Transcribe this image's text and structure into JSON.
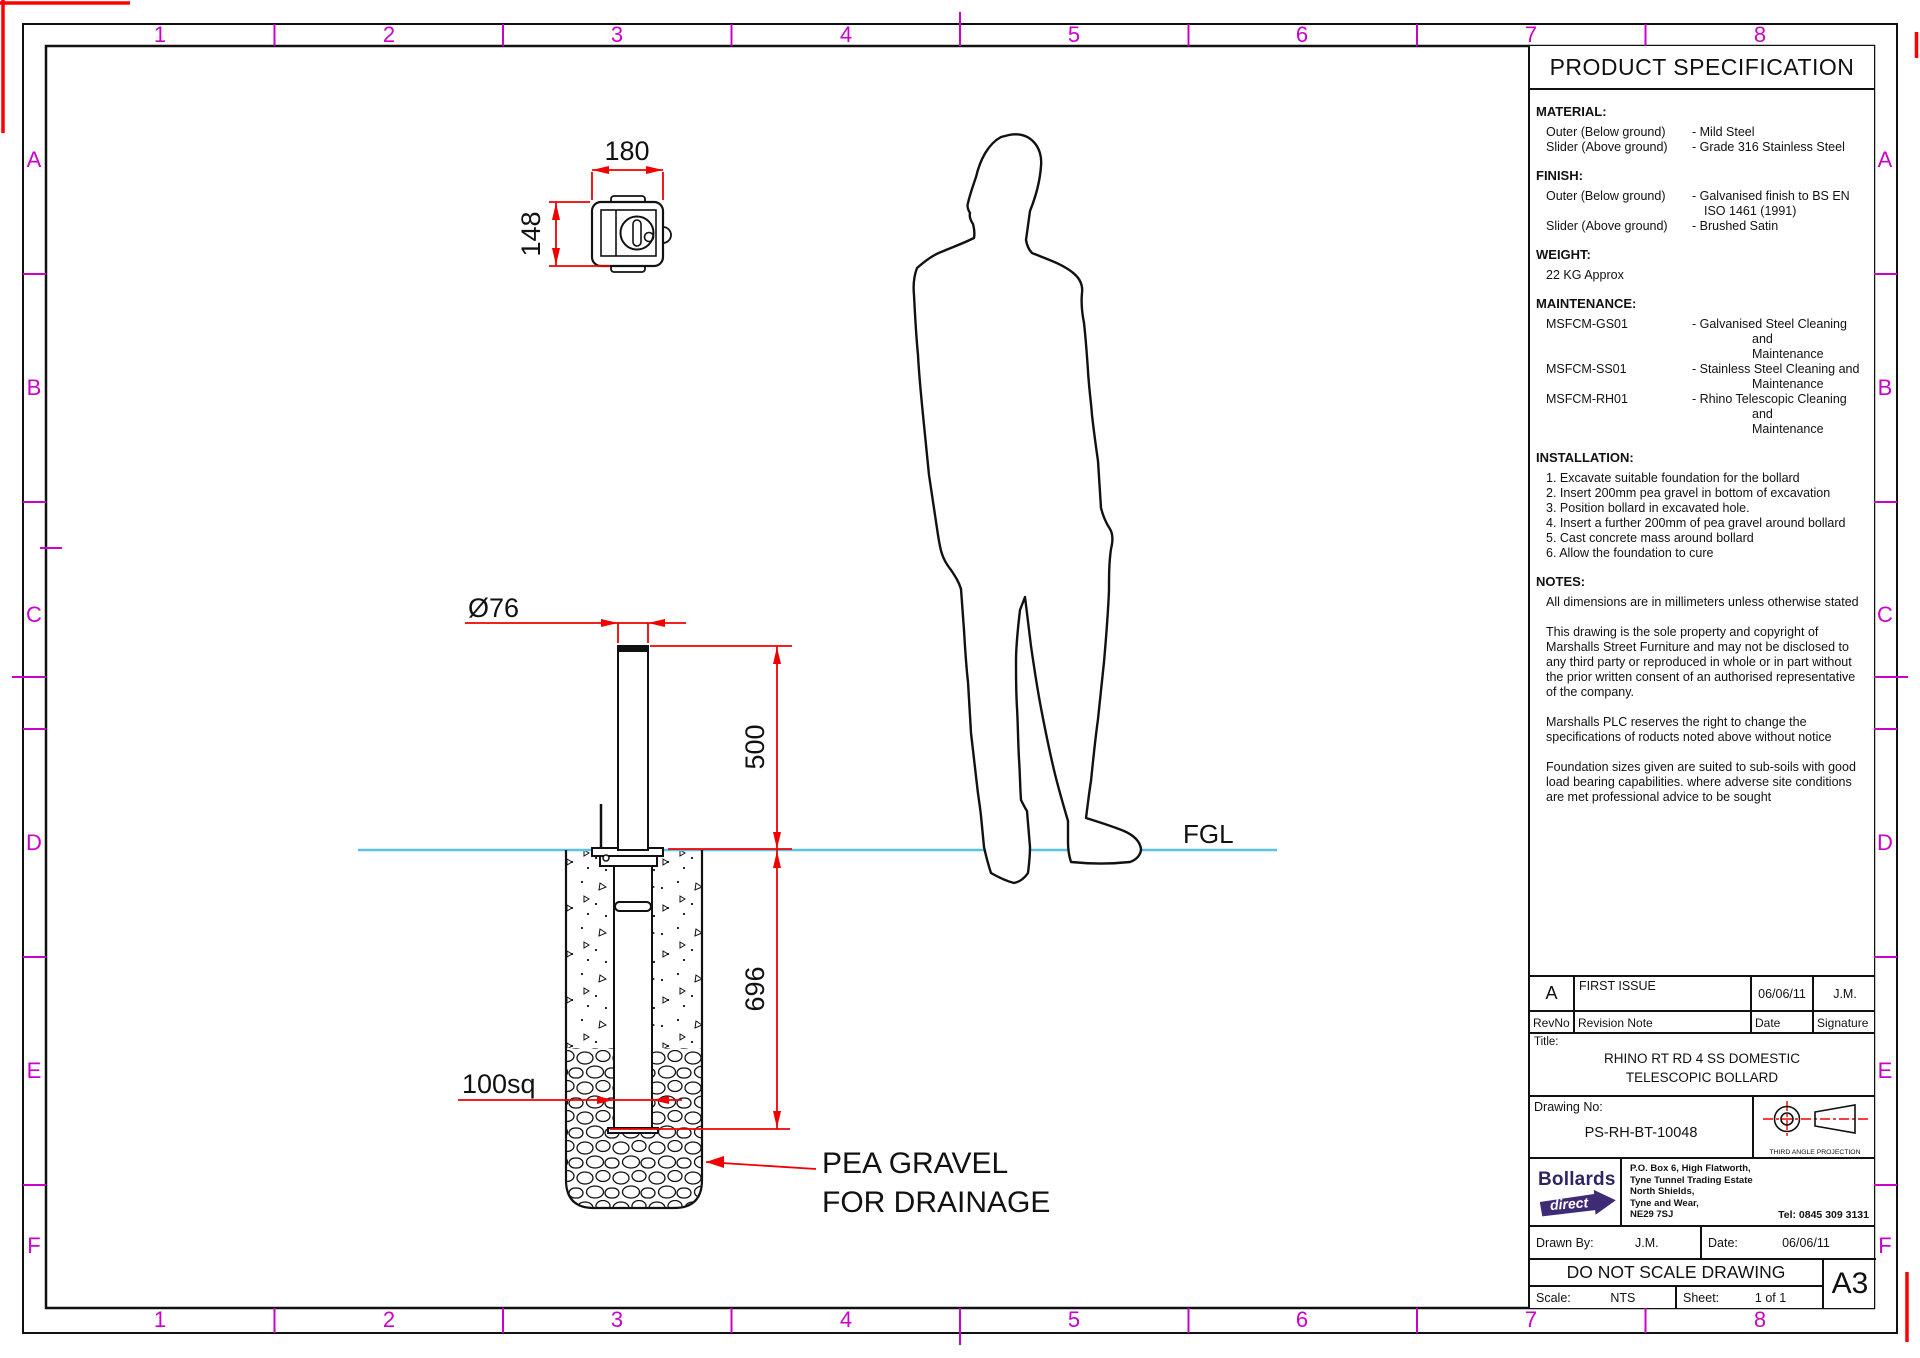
{
  "grid": {
    "top": [
      "1",
      "2",
      "3",
      "4",
      "5",
      "6",
      "7",
      "8"
    ],
    "bottom": [
      "1",
      "2",
      "3",
      "4",
      "5",
      "6",
      "7",
      "8"
    ],
    "left": [
      "A",
      "B",
      "C",
      "D",
      "E",
      "F"
    ],
    "right": [
      "A",
      "B",
      "C",
      "D",
      "E",
      "F"
    ],
    "label_color": "#cc00cc"
  },
  "drawing": {
    "dims": {
      "plan_width": "180",
      "plan_height": "148",
      "post_dia": "Ø76",
      "above_ground": "500",
      "below_ground": "696",
      "tube_square": "100sq"
    },
    "labels": {
      "fgl": "FGL",
      "pea_line1": "PEA GRAVEL",
      "pea_line2": "FOR DRAINAGE"
    },
    "colors": {
      "dimension": "#f00000",
      "corner_mark": "#ff0000",
      "ground_line": "#5bc2e7",
      "grid_tick": "#cc00cc",
      "outline": "#111111"
    }
  },
  "spec_panel": {
    "header": "PRODUCT SPECIFICATION",
    "material": {
      "heading": "MATERIAL:",
      "rows": [
        {
          "name": "Outer (Below ground)",
          "value": "- Mild Steel"
        },
        {
          "name": "Slider (Above ground)",
          "value": "- Grade 316 Stainless Steel"
        }
      ]
    },
    "finish": {
      "heading": "FINISH:",
      "rows": [
        {
          "name": "Outer (Below ground)",
          "value": "- Galvanised finish to BS EN\nISO 1461 (1991)"
        },
        {
          "name": "Slider (Above ground)",
          "value": "- Brushed Satin"
        }
      ]
    },
    "weight": {
      "heading": "WEIGHT:",
      "value": "22 KG Approx"
    },
    "maintenance": {
      "heading": "MAINTENANCE:",
      "rows": [
        {
          "name": "MSFCM-GS01",
          "value": "- Galvanised Steel Cleaning and\nMaintenance"
        },
        {
          "name": "MSFCM-SS01",
          "value": "- Stainless Steel Cleaning and\nMaintenance"
        },
        {
          "name": "MSFCM-RH01",
          "value": "- Rhino Telescopic Cleaning and\nMaintenance"
        }
      ]
    },
    "installation": {
      "heading": "INSTALLATION:",
      "steps": [
        "1. Excavate suitable foundation for the bollard",
        "2. Insert 200mm pea gravel in bottom of excavation",
        "3. Position bollard in excavated hole.",
        "4. Insert a further 200mm of pea gravel around bollard",
        "5. Cast concrete mass around bollard",
        "6. Allow the foundation to cure"
      ]
    },
    "notes": {
      "heading": "NOTES:",
      "paragraphs": [
        "All dimensions are in millimeters unless otherwise stated",
        "This drawing is the sole property and copyright of Marshalls Street Furniture and may not be disclosed to any third party or reproduced in whole or in part without the prior written consent of an authorised representative of the company.",
        "Marshalls PLC reserves the right to change the specifications of roducts noted above without notice",
        "Foundation sizes given are suited to sub-soils with good load bearing capabilities. where adverse site conditions are met professional advice to be sought"
      ]
    }
  },
  "revision": {
    "headers": {
      "rev": "RevNo",
      "note": "Revision Note",
      "date": "Date",
      "sig": "Signature"
    },
    "rows": [
      {
        "rev": "A",
        "note": "FIRST ISSUE",
        "date": "06/06/11",
        "sig": "J.M."
      }
    ]
  },
  "title_box": {
    "label": "Title:",
    "line1": "RHINO RT RD 4 SS DOMESTIC",
    "line2": "TELESCOPIC BOLLARD"
  },
  "drawing_no": {
    "label": "Drawing No:",
    "value": "PS-RH-BT-10048"
  },
  "projection": {
    "caption": "THIRD ANGLE PROJECTION"
  },
  "company": {
    "logo_line1": "Bollards",
    "logo_line2": "direct",
    "logo_color": "#3f2a75",
    "address": [
      "P.O. Box 6, High Flatworth,",
      "Tyne Tunnel Trading Estate",
      "North Shields,",
      "Tyne and Wear,",
      "NE29 7SJ"
    ],
    "tel": "Tel:  0845 309 3131"
  },
  "footer": {
    "drawn_by_label": "Drawn By:",
    "drawn_by": "J.M.",
    "date_label": "Date:",
    "date": "06/06/11",
    "no_scale": "DO NOT SCALE DRAWING",
    "scale_label": "Scale:",
    "scale": "NTS",
    "sheet_label": "Sheet:",
    "sheet": "1 of 1",
    "size": "A3"
  }
}
